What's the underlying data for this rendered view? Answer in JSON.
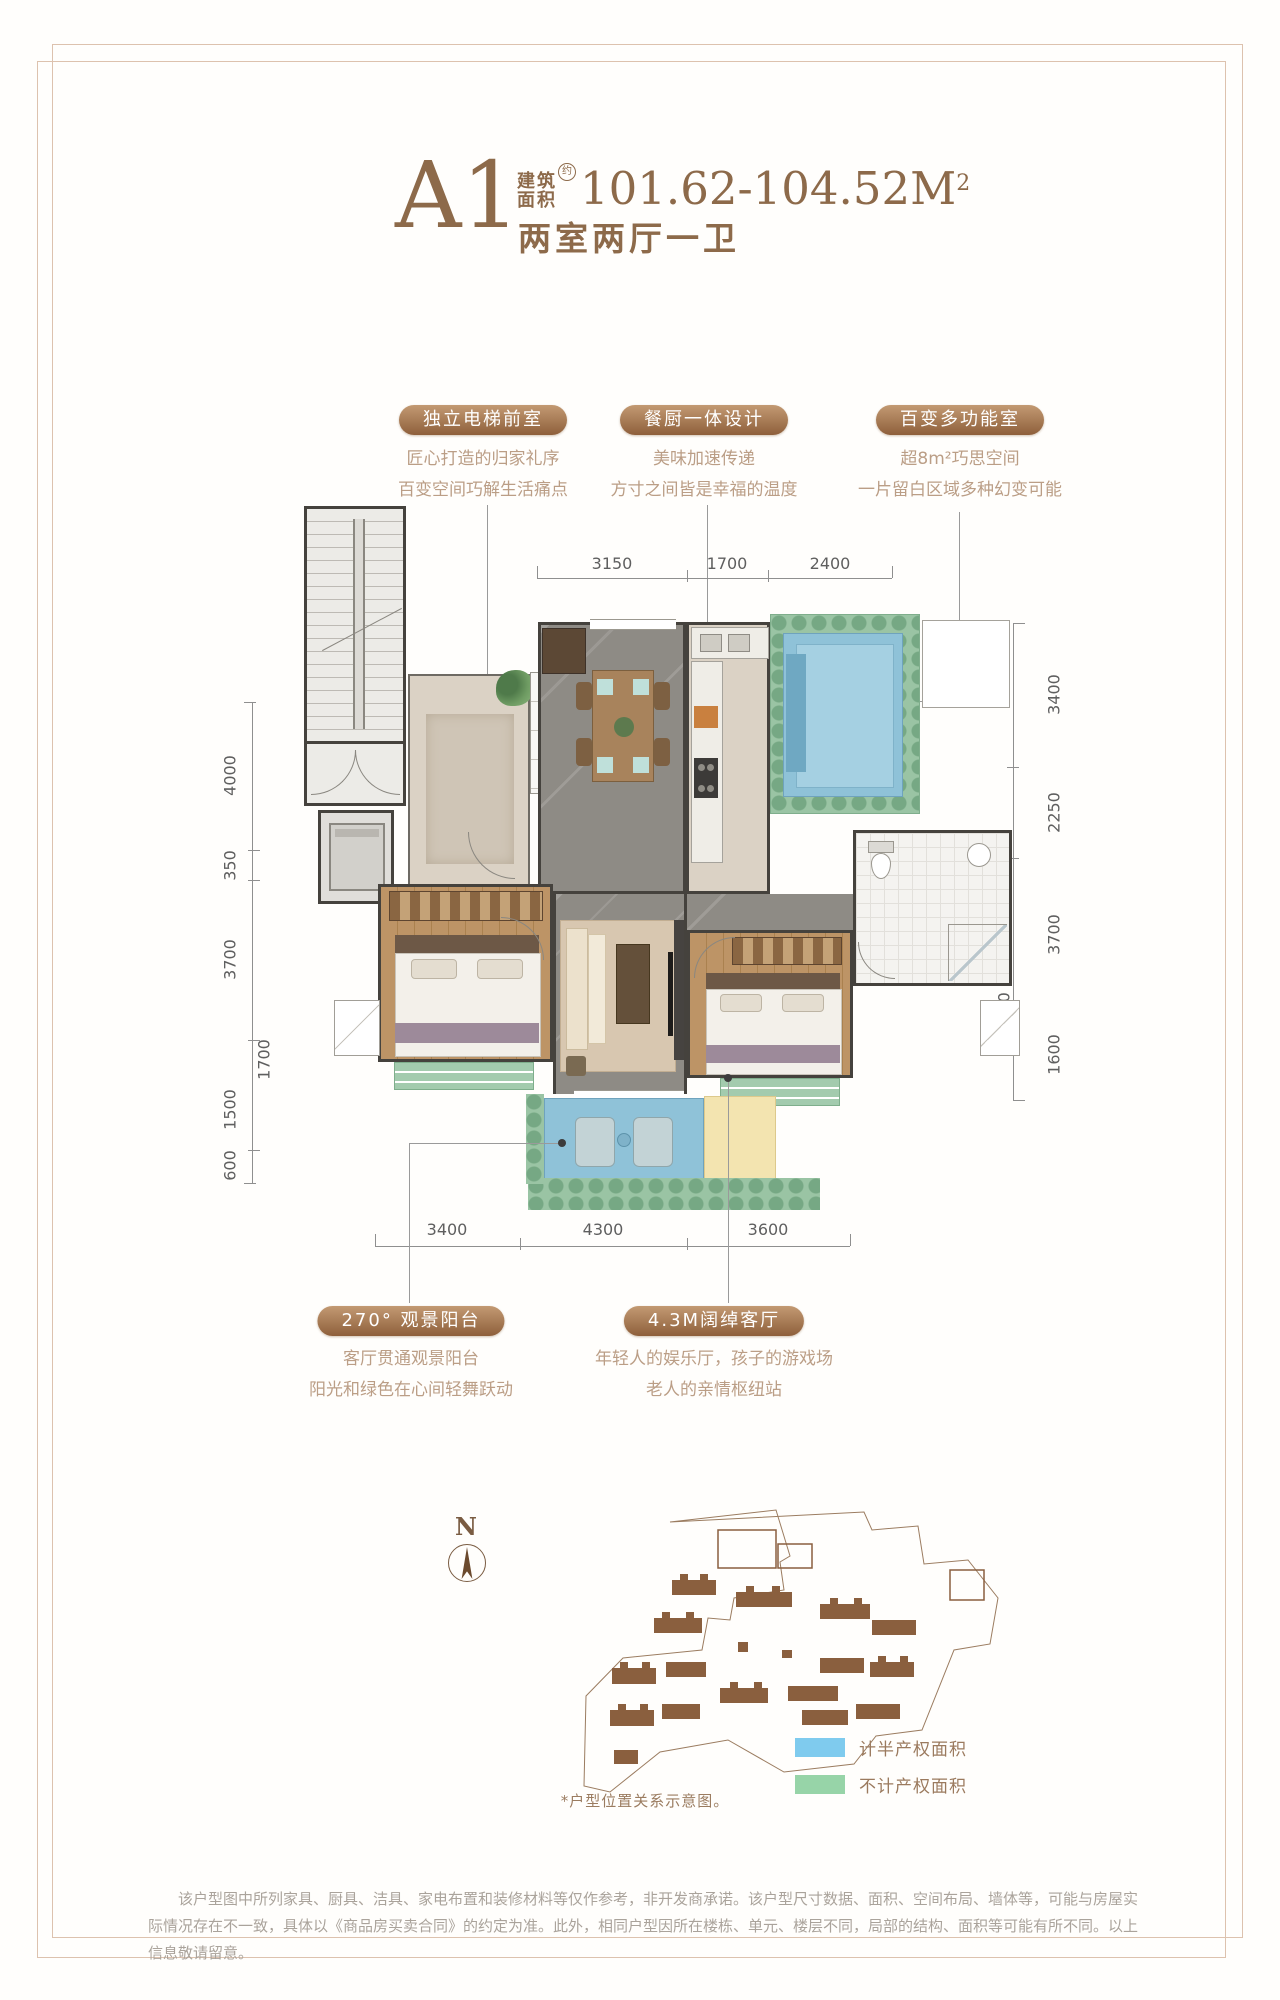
{
  "title": {
    "unit": "A1",
    "area_prefix_line1": "建筑",
    "area_prefix_line2": "面积",
    "area_note": "约",
    "area_value": "101.62-104.52M",
    "area_sup": "2",
    "layout_text": "两室两厅一卫"
  },
  "callouts_top": [
    {
      "label": "独立电梯前室",
      "line1": "匠心打造的归家礼序",
      "line2": "百变空间巧解生活痛点"
    },
    {
      "label": "餐厨一体设计",
      "line1": "美味加速传递",
      "line2": "方寸之间皆是幸福的温度"
    },
    {
      "label": "百变多功能室",
      "line1": "超8m²巧思空间",
      "line2": "一片留白区域多种幻变可能"
    }
  ],
  "callouts_bottom": [
    {
      "label": "270°  观景阳台",
      "line1": "客厅贯通观景阳台",
      "line2": "阳光和绿色在心间轻舞跃动"
    },
    {
      "label": "4.3M阔绰客厅",
      "line1": "年轻人的娱乐厅，孩子的游戏场",
      "line2": "老人的亲情枢纽站"
    }
  ],
  "dimensions": {
    "top": [
      "3150",
      "1700",
      "2400"
    ],
    "bottom": [
      "3400",
      "4300",
      "3600"
    ],
    "left": [
      "4000",
      "350",
      "3700",
      "1500",
      "600"
    ],
    "left_inner": "1700",
    "right": [
      "3400",
      "2250",
      "3700",
      "1600"
    ],
    "right_inner": "1700"
  },
  "legend": {
    "items": [
      {
        "label": "计半产权面积",
        "color": "#7fcbee"
      },
      {
        "label": "不计产权面积",
        "color": "#97d4a8"
      }
    ]
  },
  "compass_label": "N",
  "site_caption": "*户型位置关系示意图。",
  "footnote": "该户型图中所列家具、厨具、洁具、家电布置和装修材料等仅作参考，非开发商承诺。该户型尺寸数据、面积、空间布局、墙体等，可能与房屋实际情况存在不一致，具体以《商品房买卖合同》的约定为准。此外，相同户型因所在楼栋、单元、楼层不同，局部的结构、面积等可能有所不同。以上信息敬请留意。",
  "colors": {
    "accent_brown": "#8d6a4a",
    "pill_gradient_top": "#c39a73",
    "pill_gradient_bottom": "#8e5f3b",
    "half_property_blue": "#7fcbee",
    "no_property_green": "#97d4a8",
    "frame_border": "#ddc2ae"
  }
}
